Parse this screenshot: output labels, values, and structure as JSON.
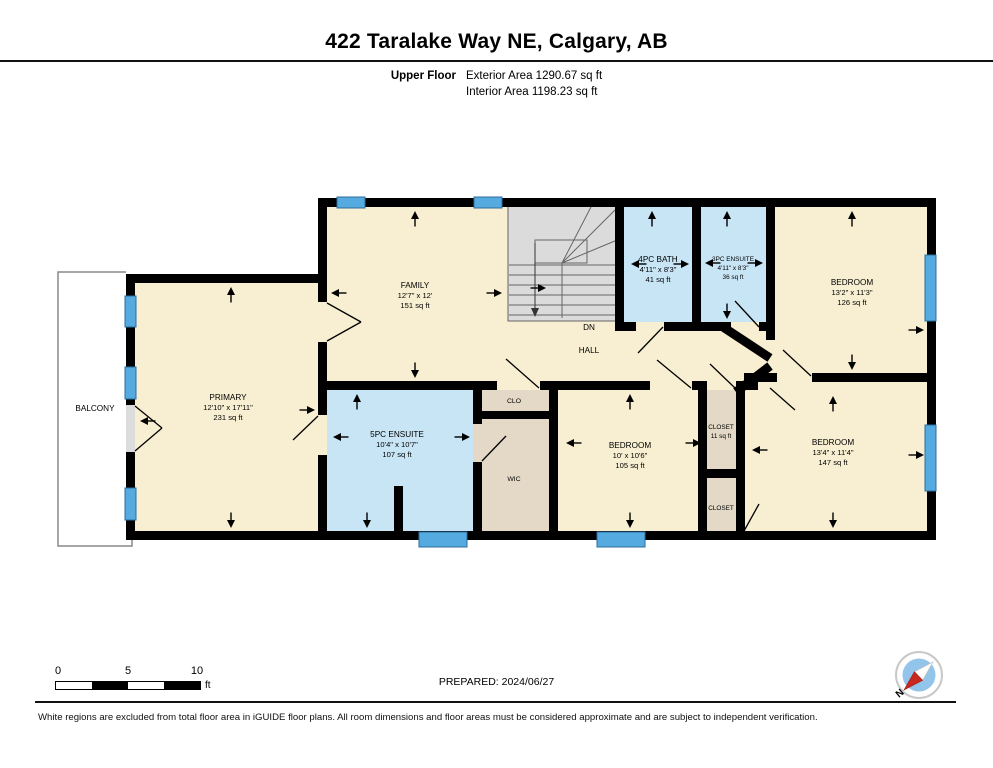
{
  "header": {
    "title": "422 Taralake Way NE, Calgary, AB",
    "floor_label": "Upper Floor",
    "exterior_area": "Exterior Area 1290.67 sq ft",
    "interior_area": "Interior Area 1198.23 sq ft"
  },
  "colors": {
    "wall": "#000000",
    "cream": "#F8EFD2",
    "bath": "#C8E5F6",
    "tan": "#E3D9C6",
    "stairs": "#DBDBDB",
    "window": "#55AADF",
    "compass_red": "#C8281E",
    "compass_blue": "#93C4EA"
  },
  "plan": {
    "rooms": [
      {
        "name": "FAMILY",
        "dims": "12'7\" x 12'",
        "area": "151 sq ft"
      },
      {
        "name": "PRIMARY",
        "dims": "12'10\" x 17'11\"",
        "area": "231 sq ft"
      },
      {
        "name": "5PC ENSUITE",
        "dims": "10'4\" x 10'7\"",
        "area": "107 sq ft"
      },
      {
        "name": "4PC BATH",
        "dims": "4'11\" x 8'3\"",
        "area": "41 sq ft"
      },
      {
        "name": "3PC ENSUITE",
        "dims": "4'11\" x 8'3\"",
        "area": "36 sq ft"
      },
      {
        "name": "BEDROOM",
        "dims": "13'2\" x 11'3\"",
        "area": "126 sq ft"
      },
      {
        "name": "BEDROOM",
        "dims": "10' x 10'6\"",
        "area": "105 sq ft"
      },
      {
        "name": "BEDROOM",
        "dims": "13'4\" x 11'4\"",
        "area": "147 sq ft"
      }
    ],
    "labels": {
      "balcony": "BALCONY",
      "hall": "HALL",
      "dn": "DN",
      "clo": "CLO",
      "wic": "WIC",
      "closet1_name": "CLOSET",
      "closet1_area": "11 sq ft",
      "closet2_name": "CLOSET"
    }
  },
  "scalebar": {
    "t0": "0",
    "t5": "5",
    "t10": "10",
    "unit": "ft"
  },
  "footer": {
    "prepared": "PREPARED: 2024/06/27",
    "north": "N",
    "disclaimer": "White regions are excluded from total floor area in iGUIDE floor plans. All room dimensions and floor areas must be considered approximate and are subject to independent verification."
  }
}
